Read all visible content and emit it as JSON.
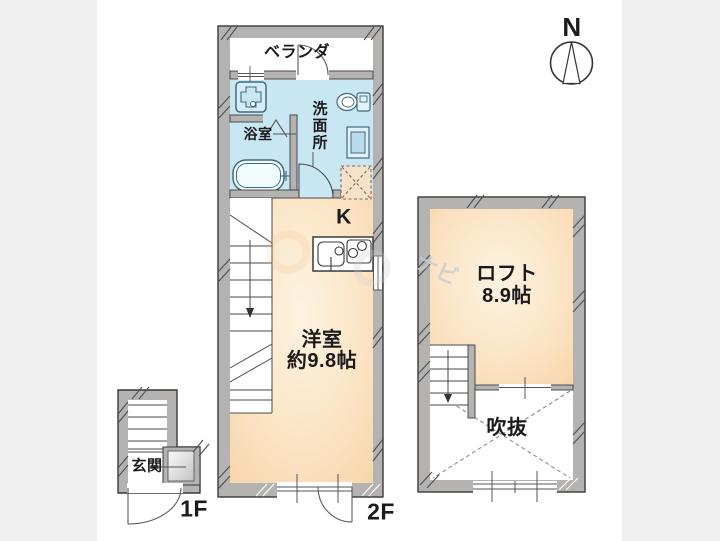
{
  "compass": {
    "north_label": "N"
  },
  "unit_1f": {
    "veranda": "ベランダ",
    "bathroom": "浴室",
    "washroom": "洗面所",
    "kitchen": "K",
    "room_name": "洋室",
    "room_size": "約9.8帖",
    "floor_label": "2F"
  },
  "entrance_block": {
    "entrance": "玄関",
    "floor_label": "1F"
  },
  "loft_block": {
    "loft_name": "ロフト",
    "loft_size": "8.9帖",
    "void_label": "吹抜"
  },
  "watermark": {
    "text": "ナビ"
  },
  "colors": {
    "wall_gray": "#b4b3b2",
    "wet_area_blue": "#c9e6f3",
    "room_floor_peach": "#f8dbb2",
    "side_band_gray": "#f0f0f1",
    "fixture_line_blue": "#3f6b80"
  }
}
